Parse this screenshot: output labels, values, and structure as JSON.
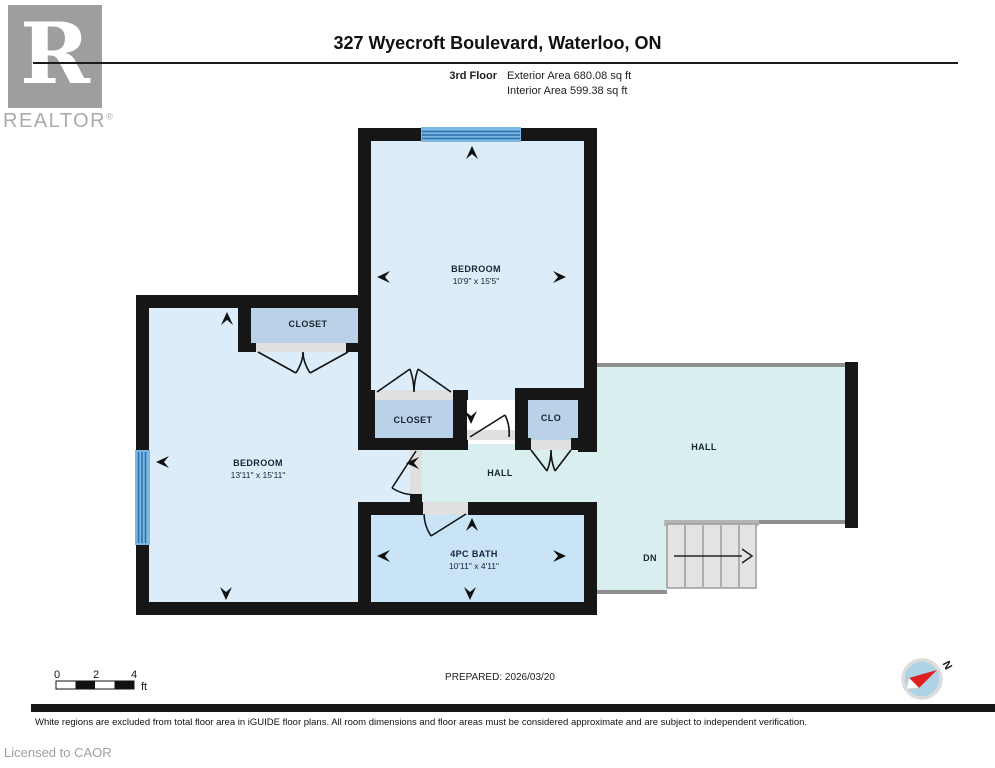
{
  "header": {
    "brand_r": "R",
    "brand": "REALTOR",
    "brand_reg": "®",
    "title": "327 Wyecroft Boulevard, Waterloo, ON",
    "floor_label": "3rd Floor",
    "exterior_area": "Exterior Area 680.08 sq ft",
    "interior_area": "Interior Area 599.38 sq ft"
  },
  "plan": {
    "top_bedroom": {
      "name": "BEDROOM",
      "dims": "10'9\" x 15'5\""
    },
    "left_bedroom": {
      "name": "BEDROOM",
      "dims": "13'11\" x 15'11\""
    },
    "bath": {
      "name": "4PC BATH",
      "dims": "10'11\" x 4'11\""
    },
    "closet_top": "CLOSET",
    "closet_mid": "CLOSET",
    "closet_small": "CLO",
    "hall_center": "HALL",
    "hall_right": "HALL",
    "stairs_label": "DN"
  },
  "scale_bar": {
    "t0": "0",
    "t2": "2",
    "t4": "4",
    "unit": "ft"
  },
  "compass": {
    "north": "N"
  },
  "footer": {
    "prepared": "PREPARED: 2026/03/20",
    "disclaimer": "White regions are excluded from total floor area in iGUIDE floor plans. All room dimensions and floor areas must be considered approximate and are subject to independent verification.",
    "license": "Licensed to CAOR"
  },
  "colors": {
    "wall": "#161616",
    "room": "#dcedf9",
    "closet": "#b9d2e8",
    "hall": "#d9eeee",
    "bath": "#c9e3f7",
    "window": "#7ab7e3",
    "window_line": "#2d6fa9",
    "opening": "#e0e0e0",
    "stairs": "#e3e3e3",
    "compass_red": "#e02020"
  }
}
